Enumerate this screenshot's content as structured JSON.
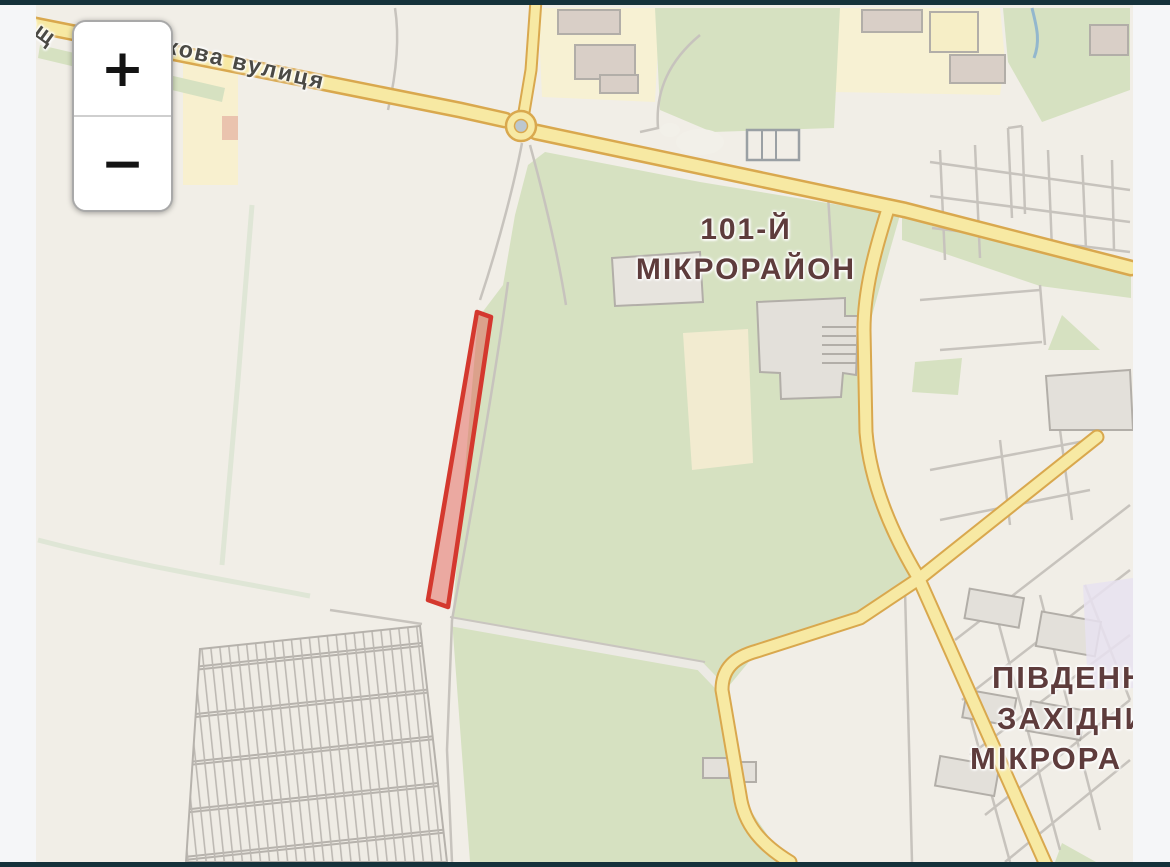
{
  "map": {
    "controls": {
      "zoom_in": "+",
      "zoom_out": "−"
    },
    "labels": {
      "street": "ставкова вулиця",
      "street_fragment": "ощ",
      "district_101": {
        "lines": [
          "101-Й",
          "МІКРОРАЙОН"
        ]
      },
      "district_southwest": {
        "lines": [
          "ПІВДЕНН",
          "ЗАХІДНИ",
          "МІКРОРА"
        ]
      }
    },
    "highlight": {
      "description": "selected land parcel",
      "fill": "rgba(227,74,64,0.42)",
      "stroke": "#d4382e"
    },
    "colors": {
      "background": "#f1eee7",
      "green_area": "#d6e1c1",
      "field_path_green": "#dfe6d6",
      "road_fill": "#f7e9a3",
      "road_casing": "#d9a84e",
      "minor_road": "#c7c3bd",
      "building_fill": "#e3e0da",
      "building_outline": "#b2aea8",
      "yellow_block": "#f7f1d3",
      "water": "#93b7cd",
      "lavender_block": "#e7e2f0",
      "label_maroon": "#5e3c3c",
      "street_label_gray": "#4b4a45",
      "app_bar": "#15323b",
      "frame": "#f5f6f8"
    }
  }
}
